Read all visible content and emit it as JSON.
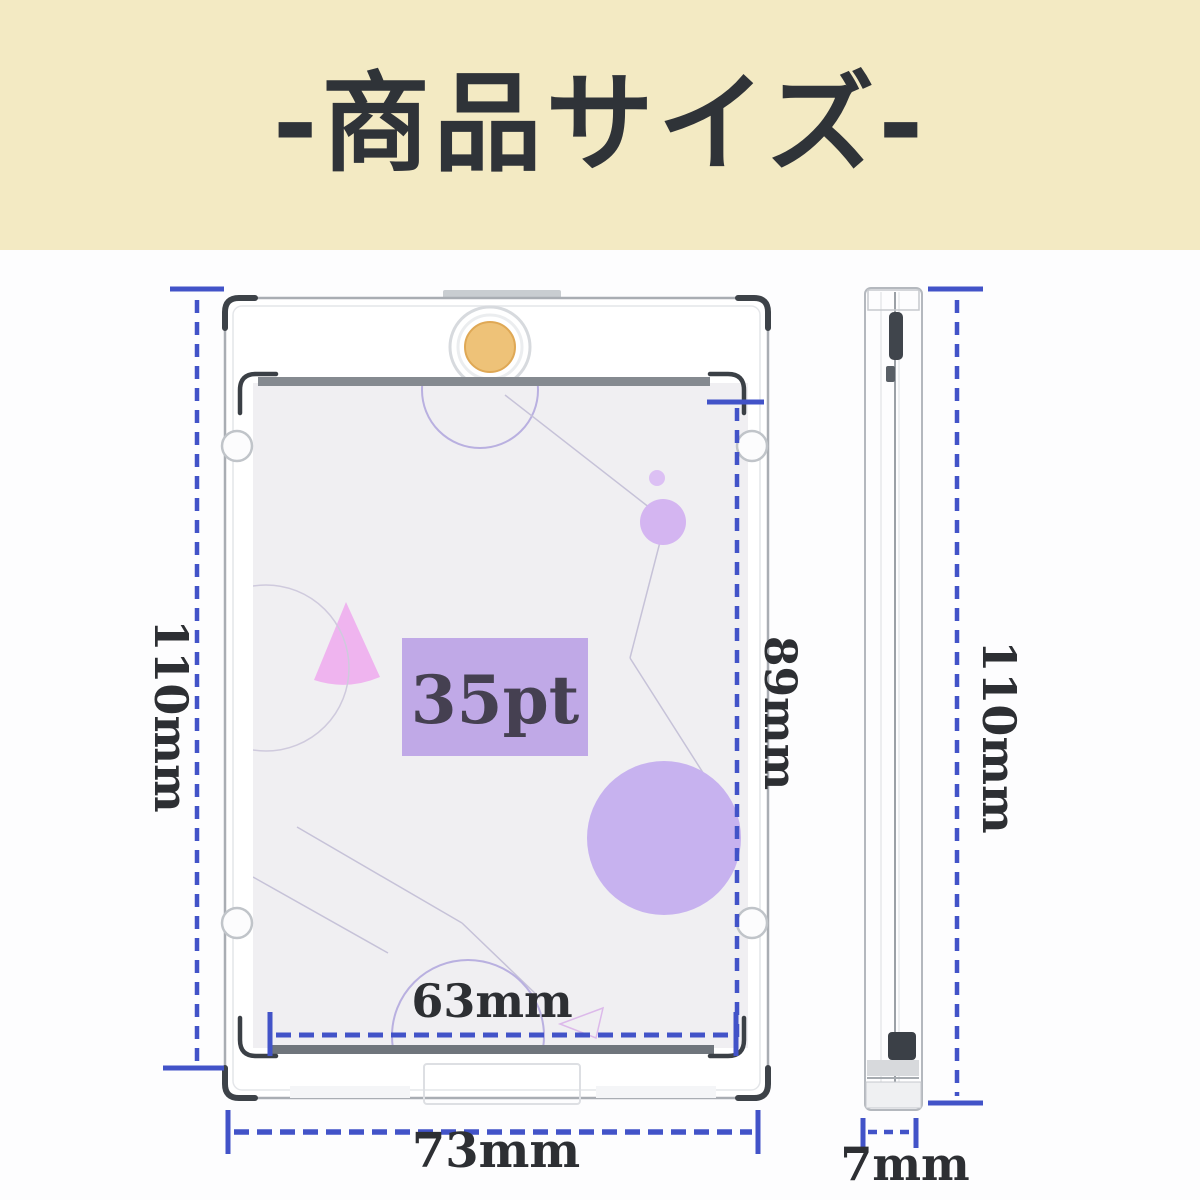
{
  "header": {
    "title": "-商品サイズ-"
  },
  "front_view": {
    "pt_label": "35pt",
    "outer_height": "110mm",
    "inner_height": "89mm",
    "inner_width": "63mm",
    "outer_width": "73mm"
  },
  "side_view": {
    "height": "110mm",
    "thickness": "7mm"
  },
  "colors": {
    "header_bg": "#f3eac3",
    "header_text": "#2f3338",
    "dimension_blue": "#4253c8",
    "label_dark": "#2d2f33",
    "card_bg": "#f0eff2",
    "pt_badge_bg": "#c0a9e7",
    "accent_purple": "#c7b2ef",
    "accent_pink": "#efb4ef",
    "magnet_gold": "#eec278"
  }
}
